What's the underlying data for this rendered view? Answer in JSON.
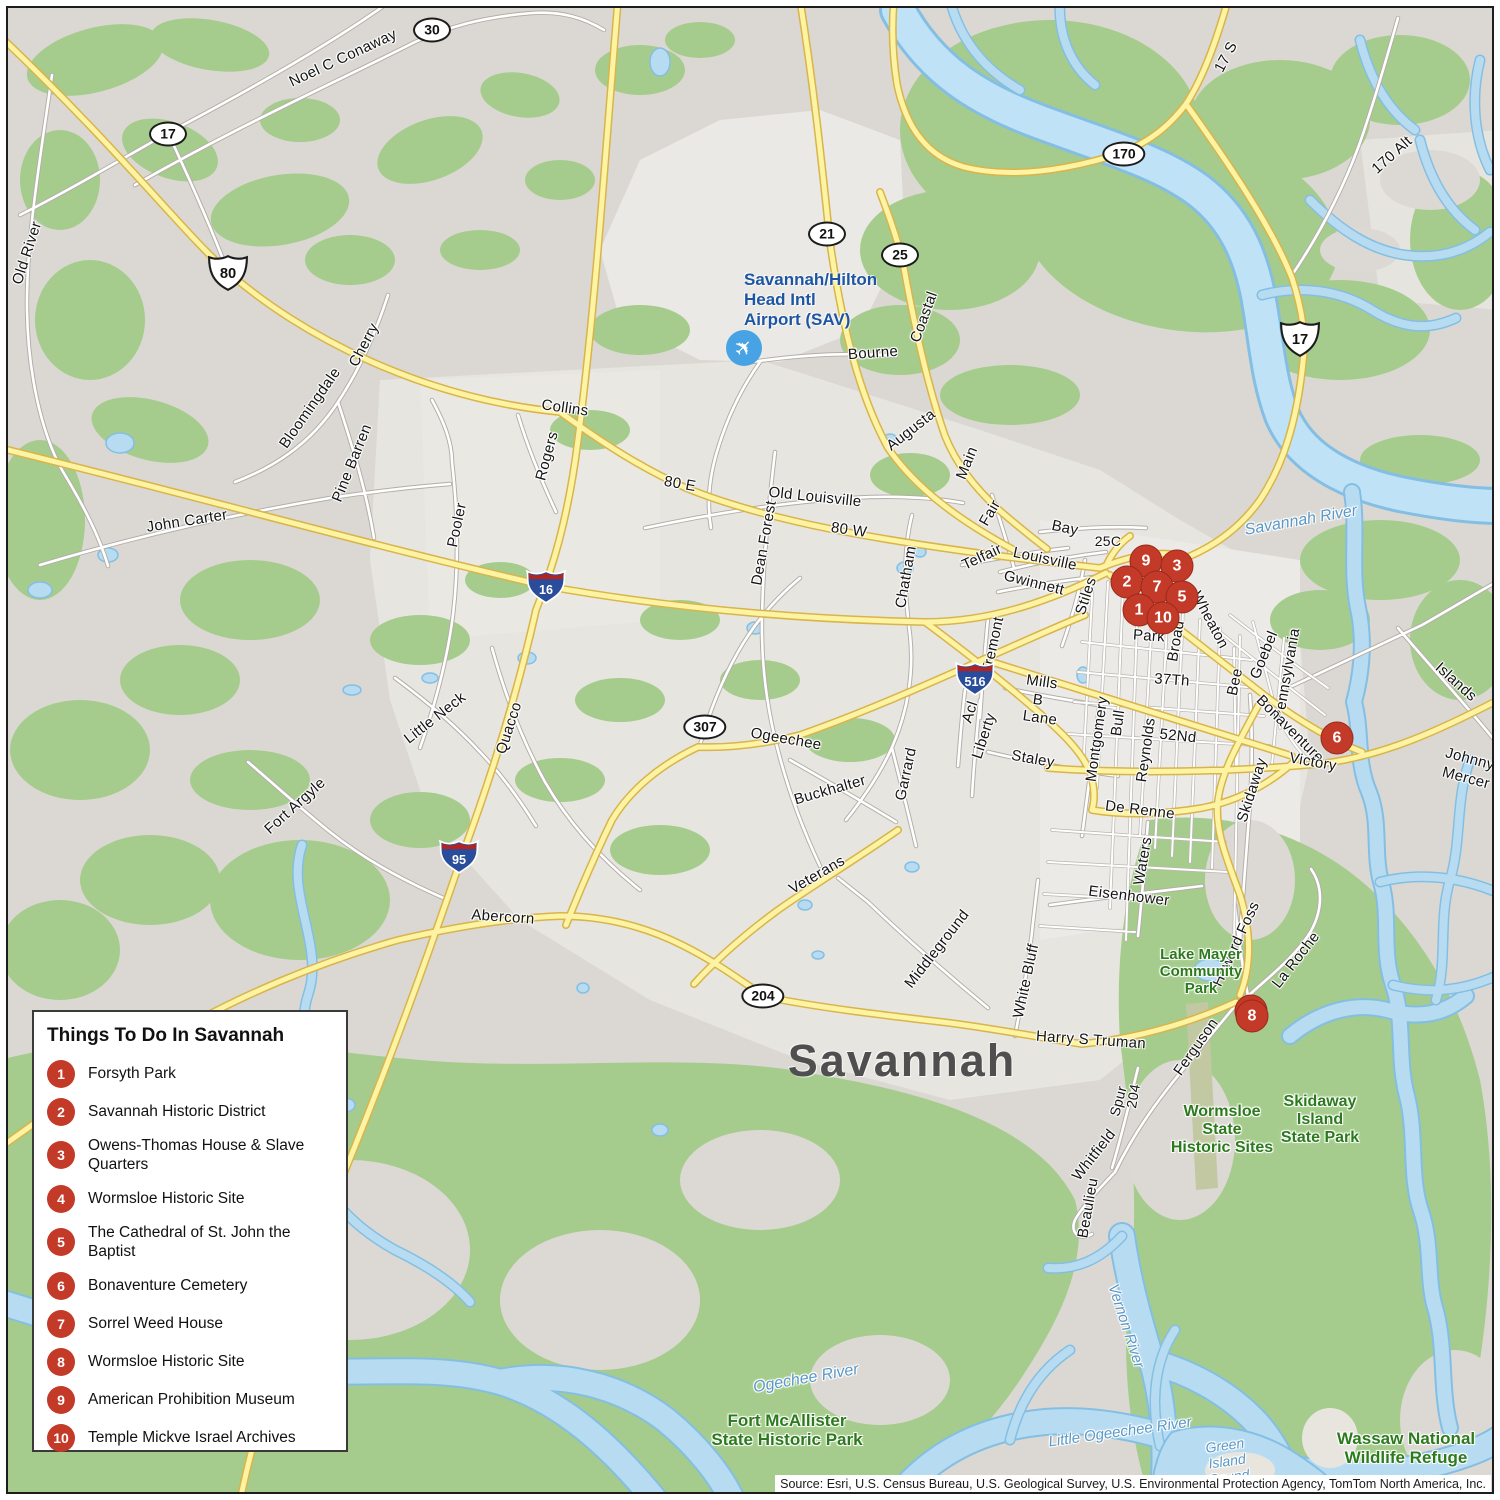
{
  "city_label": "Savannah",
  "legend": {
    "title": "Things To Do In Savannah",
    "items": [
      {
        "num": "1",
        "label": "Forsyth Park"
      },
      {
        "num": "2",
        "label": "Savannah Historic District"
      },
      {
        "num": "3",
        "label": "Owens-Thomas House & Slave Quarters"
      },
      {
        "num": "4",
        "label": "Wormsloe Historic Site"
      },
      {
        "num": "5",
        "label": "The Cathedral of St. John the Baptist"
      },
      {
        "num": "6",
        "label": "Bonaventure Cemetery"
      },
      {
        "num": "7",
        "label": "Sorrel Weed House"
      },
      {
        "num": "8",
        "label": "Wormsloe Historic Site"
      },
      {
        "num": "9",
        "label": "American Prohibition Museum"
      },
      {
        "num": "10",
        "label": "Temple Mickve Israel Archives"
      }
    ]
  },
  "markers": [
    {
      "n": "9",
      "x": 1146,
      "y": 561
    },
    {
      "n": "3",
      "x": 1177,
      "y": 566
    },
    {
      "n": "2",
      "x": 1127,
      "y": 582
    },
    {
      "n": "7",
      "x": 1157,
      "y": 587
    },
    {
      "n": "5",
      "x": 1182,
      "y": 597
    },
    {
      "n": "1",
      "x": 1139,
      "y": 610
    },
    {
      "n": "10",
      "x": 1163,
      "y": 618
    },
    {
      "n": "6",
      "x": 1337,
      "y": 738
    },
    {
      "n": "4",
      "x": 1251,
      "y": 1011
    },
    {
      "n": "8",
      "x": 1252,
      "y": 1016
    }
  ],
  "shields": [
    {
      "type": "oval",
      "t": "30",
      "x": 432,
      "y": 30
    },
    {
      "type": "oval",
      "t": "17",
      "x": 168,
      "y": 134
    },
    {
      "type": "oval",
      "t": "21",
      "x": 827,
      "y": 234
    },
    {
      "type": "oval",
      "t": "25",
      "x": 900,
      "y": 255
    },
    {
      "type": "oval",
      "t": "170",
      "x": 1124,
      "y": 154
    },
    {
      "type": "oval",
      "t": "307",
      "x": 705,
      "y": 727
    },
    {
      "type": "oval",
      "t": "204",
      "x": 763,
      "y": 996
    },
    {
      "type": "us",
      "t": "80",
      "x": 228,
      "y": 273
    },
    {
      "type": "us",
      "t": "17",
      "x": 1300,
      "y": 339
    },
    {
      "type": "i",
      "t": "16",
      "x": 546,
      "y": 586
    },
    {
      "type": "i",
      "t": "95",
      "x": 459,
      "y": 856
    },
    {
      "type": "i",
      "t": "516",
      "x": 975,
      "y": 678
    }
  ],
  "road_labels": [
    {
      "t": "Noel C Conaway",
      "x": 343,
      "y": 58,
      "r": -25
    },
    {
      "t": "Old River",
      "x": 27,
      "y": 253,
      "r": -72
    },
    {
      "t": "Cherry",
      "x": 364,
      "y": 345,
      "r": -62
    },
    {
      "t": "Bloomingdale",
      "x": 310,
      "y": 408,
      "r": -55
    },
    {
      "t": "Pine Barren",
      "x": 352,
      "y": 463,
      "r": -68
    },
    {
      "t": "John Carter",
      "x": 187,
      "y": 521,
      "r": -9
    },
    {
      "t": "Collins",
      "x": 565,
      "y": 408,
      "r": 8
    },
    {
      "t": "Rogers",
      "x": 547,
      "y": 456,
      "r": -75
    },
    {
      "t": "Pooler",
      "x": 457,
      "y": 525,
      "r": -78
    },
    {
      "t": "80 E",
      "x": 680,
      "y": 484,
      "r": 10
    },
    {
      "t": "Old Louisville",
      "x": 815,
      "y": 497,
      "r": 6
    },
    {
      "t": "80 W",
      "x": 849,
      "y": 530,
      "r": 8
    },
    {
      "t": "Dean Forest",
      "x": 764,
      "y": 543,
      "r": -80
    },
    {
      "t": "Chatham",
      "x": 906,
      "y": 577,
      "r": -80
    },
    {
      "t": "Fair",
      "x": 990,
      "y": 513,
      "r": -60
    },
    {
      "t": "Telfair",
      "x": 982,
      "y": 557,
      "r": -25
    },
    {
      "t": "Bay",
      "x": 1065,
      "y": 528,
      "r": 12
    },
    {
      "t": "25C",
      "x": 1108,
      "y": 541,
      "r": 0,
      "s": 14
    },
    {
      "t": "Louisville",
      "x": 1045,
      "y": 559,
      "r": 12
    },
    {
      "t": "Gwinnett",
      "x": 1034,
      "y": 583,
      "r": 14
    },
    {
      "t": "Stiles",
      "x": 1086,
      "y": 596,
      "r": -72
    },
    {
      "t": "Tremont",
      "x": 993,
      "y": 645,
      "r": -78
    },
    {
      "t": "Mills",
      "x": 1042,
      "y": 682,
      "r": 8
    },
    {
      "t": "B",
      "x": 1038,
      "y": 700,
      "r": 8
    },
    {
      "t": "Lane",
      "x": 1040,
      "y": 718,
      "r": 8
    },
    {
      "t": "Acl",
      "x": 970,
      "y": 712,
      "r": -72
    },
    {
      "t": "Liberty",
      "x": 984,
      "y": 736,
      "r": -72
    },
    {
      "t": "Ogeechee",
      "x": 786,
      "y": 739,
      "r": 10
    },
    {
      "t": "Buckhalter",
      "x": 830,
      "y": 790,
      "r": -16
    },
    {
      "t": "Garrard",
      "x": 906,
      "y": 774,
      "r": -78
    },
    {
      "t": "Staley",
      "x": 1033,
      "y": 759,
      "r": 10
    },
    {
      "t": "Montgomery",
      "x": 1097,
      "y": 739,
      "r": -82
    },
    {
      "t": "Bull",
      "x": 1118,
      "y": 723,
      "r": -82
    },
    {
      "t": "Reynolds",
      "x": 1146,
      "y": 750,
      "r": -82
    },
    {
      "t": "52Nd",
      "x": 1178,
      "y": 736,
      "r": 6
    },
    {
      "t": "37Th",
      "x": 1172,
      "y": 680,
      "r": 4
    },
    {
      "t": "Park",
      "x": 1149,
      "y": 636,
      "r": 4
    },
    {
      "t": "Broad",
      "x": 1176,
      "y": 641,
      "r": -80
    },
    {
      "t": "Wheaton",
      "x": 1210,
      "y": 620,
      "r": 62
    },
    {
      "t": "Bee",
      "x": 1235,
      "y": 682,
      "r": -78
    },
    {
      "t": "Goebel",
      "x": 1264,
      "y": 655,
      "r": -68
    },
    {
      "t": "Pennsylvania",
      "x": 1287,
      "y": 674,
      "r": -80
    },
    {
      "t": "Bonaventure",
      "x": 1290,
      "y": 729,
      "r": 45
    },
    {
      "t": "Victory",
      "x": 1313,
      "y": 762,
      "r": 10
    },
    {
      "t": "Skidaway",
      "x": 1252,
      "y": 790,
      "r": -72
    },
    {
      "t": "Islands",
      "x": 1456,
      "y": 682,
      "r": 42
    },
    {
      "t": "Johnny",
      "x": 1470,
      "y": 759,
      "r": 15
    },
    {
      "t": "Mercer",
      "x": 1466,
      "y": 778,
      "r": 15
    },
    {
      "t": "De Renne",
      "x": 1140,
      "y": 810,
      "r": 7
    },
    {
      "t": "Waters",
      "x": 1143,
      "y": 861,
      "r": -80
    },
    {
      "t": "Eisenhower",
      "x": 1129,
      "y": 896,
      "r": 7
    },
    {
      "t": "Middleground",
      "x": 937,
      "y": 949,
      "r": -52
    },
    {
      "t": "White Bluff",
      "x": 1026,
      "y": 981,
      "r": -78
    },
    {
      "t": "Howard Foss",
      "x": 1236,
      "y": 944,
      "r": -65
    },
    {
      "t": "La Roche",
      "x": 1296,
      "y": 960,
      "r": -52
    },
    {
      "t": "Harry S Truman",
      "x": 1091,
      "y": 1040,
      "r": 4
    },
    {
      "t": "Ferguson",
      "x": 1196,
      "y": 1047,
      "r": -55
    },
    {
      "t": "204",
      "x": 1133,
      "y": 1096,
      "r": -80,
      "s": 14
    },
    {
      "t": "Spur",
      "x": 1118,
      "y": 1101,
      "r": -75,
      "s": 14
    },
    {
      "t": "Whitfield",
      "x": 1094,
      "y": 1155,
      "r": -52
    },
    {
      "t": "Beaulieu",
      "x": 1088,
      "y": 1208,
      "r": -80
    },
    {
      "t": "Veterans",
      "x": 817,
      "y": 875,
      "r": -30
    },
    {
      "t": "Abercorn",
      "x": 503,
      "y": 917,
      "r": 4
    },
    {
      "t": "Quacco",
      "x": 509,
      "y": 728,
      "r": -72
    },
    {
      "t": "Little Neck",
      "x": 435,
      "y": 718,
      "r": -38
    },
    {
      "t": "Fort Argyle",
      "x": 295,
      "y": 806,
      "r": -42
    },
    {
      "t": "Coastal",
      "x": 924,
      "y": 317,
      "r": -70
    },
    {
      "t": "Bourne",
      "x": 873,
      "y": 353,
      "r": -4
    },
    {
      "t": "Augusta",
      "x": 911,
      "y": 430,
      "r": -38
    },
    {
      "t": "Main",
      "x": 967,
      "y": 463,
      "r": -68
    },
    {
      "t": "17 S",
      "x": 1226,
      "y": 57,
      "r": -62
    },
    {
      "t": "170 Alt",
      "x": 1392,
      "y": 155,
      "r": -42
    }
  ],
  "water_labels": [
    {
      "t": "Savannah River",
      "x": 1301,
      "y": 521,
      "r": -10,
      "s": 16
    },
    {
      "t": "Ogechee River",
      "x": 806,
      "y": 1379,
      "r": -10,
      "s": 16
    },
    {
      "t": "Little Ogeechee River",
      "x": 1120,
      "y": 1432,
      "r": -8,
      "s": 15
    },
    {
      "t": "Vernon River",
      "x": 1126,
      "y": 1326,
      "r": 72,
      "s": 15
    },
    {
      "lines": [
        "Green",
        "Island",
        "Sound"
      ],
      "x": 1227,
      "y": 1461,
      "r": -8,
      "s": 14
    }
  ],
  "park_labels": [
    {
      "lines": [
        "Lake Mayer",
        "Community",
        "Park"
      ],
      "x": 1201,
      "y": 972,
      "s": 15
    },
    {
      "lines": [
        "Wormsloe",
        "State",
        "Historic Sites"
      ],
      "x": 1222,
      "y": 1130,
      "s": 16
    },
    {
      "lines": [
        "Skidaway",
        "Island",
        "State Park"
      ],
      "x": 1320,
      "y": 1120,
      "s": 16
    },
    {
      "lines": [
        "Fort McAllister",
        "State Historic Park"
      ],
      "x": 787,
      "y": 1430,
      "s": 17
    },
    {
      "lines": [
        "Wassaw National",
        "Wildlife Refuge"
      ],
      "x": 1406,
      "y": 1448,
      "s": 17
    }
  ],
  "airport": {
    "lines": [
      "Savannah/Hilton",
      "Head Intl",
      "Airport (SAV)"
    ],
    "icon": "airplane-icon"
  },
  "source": "Source: Esri, U.S. Census Bureau, U.S. Geological Survey, U.S. Environmental Protection Agency, TomTom North America, Inc.",
  "colors": {
    "marker_red": "#c43a28",
    "road_yellow": "#fcf3a3",
    "road_yellow_casing": "#d9b44a",
    "greenspace": "#a5cc8c",
    "water": "#b7dcf2",
    "park_text": "#2c7a1d",
    "water_text": "#5a98c6",
    "airport_text": "#1d55a3",
    "land": "#dbd8d3"
  }
}
